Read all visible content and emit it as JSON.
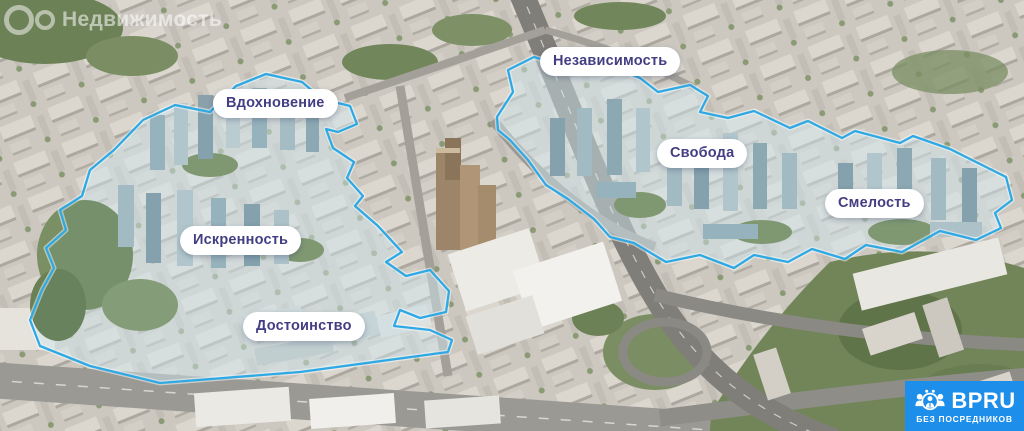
{
  "watermark": {
    "brand": "Недвижимость"
  },
  "districts": [
    {
      "name": "Вдохновение"
    },
    {
      "name": "Независимость"
    },
    {
      "name": "Свобода"
    },
    {
      "name": "Смелость"
    },
    {
      "name": "Искренность"
    },
    {
      "name": "Достоинство"
    }
  ],
  "map": {
    "outline_color": "#2fa9e4",
    "label_text_color": "#433d82"
  },
  "branding": {
    "logo": "BPRU",
    "tagline": "БЕЗ ПОСРЕДНИКОВ",
    "accent_color": "#1d8ee9"
  }
}
